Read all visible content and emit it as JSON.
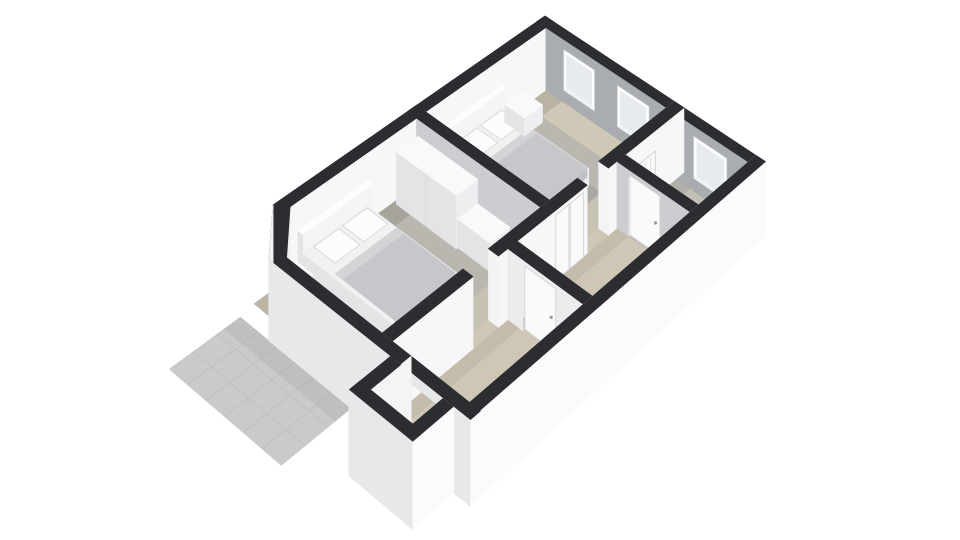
{
  "scene": {
    "title": "3D Floor Plan",
    "type": "3d-floorplan-render",
    "view": "birds-eye dollhouse rendering, no visible text",
    "rooms": [
      {
        "id": "bedroom-1",
        "desc": "large bedroom top-right with double bed, nightstand, two windows"
      },
      {
        "id": "bedroom-2",
        "desc": "bedroom left with double bed, nightstand, wardrobe and dresser"
      },
      {
        "id": "hallway",
        "desc": "central hall with staircase, interior doors and closet"
      },
      {
        "id": "bathroom",
        "desc": "small room at right corner with window and toilet"
      },
      {
        "id": "entry-bay",
        "desc": "projecting bay at lower left with window"
      },
      {
        "id": "patio",
        "desc": "outdoor tiled terrace at lower left"
      }
    ]
  },
  "palette": {
    "bg": "#ffffff",
    "wallTop": "#2b2d30",
    "wallWhite": "#f7f7f8",
    "wallLight": "#ececee",
    "wallMid": "#cbcdd0",
    "wallShade": "#d9dadc",
    "wallGrey": "#a9acb0",
    "extWhite": "#fbfbfc",
    "extLight": "#e7e8ea",
    "extChamfer": "#f0f0f2",
    "doorWhite": "#fafafa",
    "doorStroke": "#d2d2d5",
    "frame": "#ffffff",
    "glass": "#e8ebed",
    "sill": "#f1f2f3",
    "jamb": "#f4f4f5",
    "floorBedroom": "#bab7b0",
    "floorBeigeNE": "#cfc8b7",
    "floorBeigeSE": "#c8c2b3",
    "floorHall": "#cfc7b5",
    "floorBath": "#c2bfb7",
    "patio": "#c9cacc",
    "patioLine": "#bcbdbf",
    "furnWhite": "#f5f5f6",
    "furnSide": "#e4e4e7",
    "furnSide2": "#eeeef0",
    "furnTop": "#f9f9fa",
    "duvet": "#c6c7ca",
    "duvetDrape": "#bfc0c3",
    "duvetFold": "#d3d4d6",
    "mattress": "#f1f1f2",
    "pillow": "#fcfcfd",
    "pillowStroke": "#dadadd",
    "headboardTop": "#fdfdfe",
    "stairTread": "#d5cdbb",
    "stairRiser": "#f1f1f2",
    "handle": "#97979c",
    "radiatorFill": "#f9f9fa",
    "radiatorLine": "#dcdcdf",
    "wardrobeSeam": "#d8d8db",
    "shadow": "rgba(70,72,78,0.14)",
    "aoSoft": "rgba(0,0,0,0.08)",
    "aoLight": "rgba(0,0,0,0.05)",
    "aoDark": "rgba(0,0,0,0.10)",
    "beigeGlow": "rgba(235,225,200,0.45)"
  },
  "projection": {
    "corners": {
      "w": [
        234,
        232
      ],
      "n": [
        545,
        16
      ],
      "e": [
        766,
        162
      ],
      "s": [
        470,
        420
      ]
    },
    "planSize": [
      10,
      7
    ],
    "floorDepth": 72,
    "groundDepth": 80
  },
  "structure": {
    "chamfer": {
      "outerA": [
        1.1,
        0
      ],
      "outerB": [
        0,
        1.1
      ],
      "innerA": [
        1.32,
        0.3
      ],
      "innerB": [
        0.3,
        1.32
      ]
    },
    "nw": {
      "face": {
        "v": 0.3,
        "u": [
          1.32,
          9.7
        ]
      },
      "top": [
        [
          1.1,
          0
        ],
        [
          10,
          0
        ],
        [
          10,
          0.3
        ],
        [
          1.32,
          0.3
        ]
      ]
    },
    "ne": {
      "face": {
        "u": 9.7,
        "v": [
          0.3,
          6.7
        ]
      },
      "top": [
        9.7,
        0,
        10,
        7
      ]
    },
    "pa": {
      "u": [
        5.2,
        5.5
      ],
      "v": [
        0.3,
        4.2
      ],
      "top": [
        5.2,
        0,
        5.5,
        4.5
      ]
    },
    "pb": {
      "v": [
        4.2,
        4.5
      ],
      "segs": [
        [
          5.2,
          6.45
        ],
        [
          7.2,
          10
        ]
      ],
      "jambU": 7.2
    },
    "pc": {
      "u": [
        7.5,
        7.8
      ],
      "vTop": [
        4.5,
        7
      ],
      "faceV": [
        4.5,
        6.7
      ],
      "doorV": [
        4.85,
        5.75
      ]
    },
    "pd": {
      "v": [
        4.2,
        4.5
      ],
      "segs": [
        [
          0.3,
          2.7
        ],
        [
          3.5,
          5.2
        ]
      ],
      "jambU": 3.5
    },
    "pe": {
      "u": [
        3.8,
        4.1
      ],
      "vTop": [
        4.5,
        7
      ],
      "faceV": [
        4.5,
        6.7
      ],
      "doorV": [
        4.95,
        5.85
      ]
    },
    "se": {
      "intV": 6.7,
      "extV": 7,
      "u": [
        0,
        10
      ],
      "top": [
        0,
        6.7,
        10,
        7
      ]
    },
    "sw": {
      "intU": 0.3,
      "extU": 0,
      "intSegs": [
        [
          1.32,
          5.05
        ],
        [
          6.25,
          6.7
        ]
      ],
      "extSegs": [
        [
          1.1,
          5.05
        ],
        [
          6.25,
          7
        ]
      ],
      "bayGapV": [
        5.05,
        6.25
      ],
      "top": [
        [
          0,
          1.1
        ],
        [
          0,
          7
        ],
        [
          0.3,
          7
        ],
        [
          0.3,
          1.32
        ]
      ]
    },
    "bay": {
      "floor": [
        -0.85,
        5.05,
        0.3,
        6.25
      ],
      "intFace": {
        "v": 5.05,
        "u": [
          -0.85,
          0.3
        ]
      },
      "swInt": {
        "u": -0.85,
        "v": [
          5.05,
          6.25
        ]
      },
      "swExt": {
        "u": -1.15,
        "v": [
          4.75,
          6.55
        ]
      },
      "seExt": {
        "v": 6.55,
        "u": [
          -1.15,
          0
        ]
      },
      "nwTop": [
        -1.15,
        4.75,
        0,
        5.05
      ],
      "swTop": [
        -1.15,
        4.75,
        -0.85,
        6.55
      ],
      "seTop": [
        -1.15,
        6.25,
        0,
        6.55
      ]
    }
  },
  "floors": {
    "bedroom1": [
      5.5,
      0.3,
      9.7,
      4.2
    ],
    "bedroom2": [
      0.3,
      0.3,
      5.2,
      4.2
    ],
    "bathroom": [
      7.8,
      4.5,
      9.7,
      6.7
    ],
    "hallway": [
      0.3,
      4.5,
      7.5,
      6.7
    ],
    "patchPB": [
      6.45,
      4.2,
      7.2,
      4.5
    ],
    "patchPD": [
      2.7,
      4.2,
      3.5,
      4.5
    ],
    "patchPC": [
      7.5,
      4.85,
      7.8,
      5.75
    ]
  },
  "windows": [
    {
      "id": "bedroom-1-window-1",
      "wall": "ne",
      "v": [
        0.9,
        1.9
      ]
    },
    {
      "id": "bedroom-1-window-2",
      "wall": "ne",
      "v": [
        2.65,
        3.65
      ]
    },
    {
      "id": "bathroom-window",
      "wall": "ne",
      "v": [
        5.05,
        6.05
      ]
    },
    {
      "id": "bedroom-2-window",
      "wall": "sw",
      "v": [
        1.95,
        3.05
      ]
    },
    {
      "id": "bay-window",
      "wall": "bay",
      "v": [
        5.15,
        6.15
      ]
    }
  ],
  "furniture": {
    "bed1": {
      "u": [
        6.15,
        7.95
      ],
      "v": [
        0.35,
        3.05
      ]
    },
    "nightstand1": {
      "u": [
        8.15,
        8.8
      ],
      "v": [
        0.35,
        1.0
      ],
      "zTop": 52
    },
    "bed2": {
      "u": [
        1.7,
        3.5
      ],
      "v": [
        0.35,
        3.05
      ]
    },
    "nightstand2": {
      "u": [
        0.75,
        1.35
      ],
      "v": [
        0.35,
        1.0
      ],
      "zTop": 52
    },
    "wardrobe": {
      "u": [
        4.45,
        5.15
      ],
      "v": [
        0.4,
        2.3
      ],
      "zTop": 16
    },
    "dresser": {
      "u": [
        4.5,
        5.15
      ],
      "v": [
        2.3,
        3.3
      ],
      "zTop": 42
    },
    "toilet": {
      "tank": [
        8.1,
        4.62,
        8.62,
        4.88
      ],
      "bowl": [
        8.18,
        4.88,
        8.54,
        5.3
      ]
    },
    "radiator": {
      "u": [
        8.0,
        8.9
      ],
      "z": [
        22,
        52
      ],
      "v": 4.51
    },
    "closetDoors": {
      "panels": [
        [
          5.35,
          5.8
        ],
        [
          5.84,
          6.3
        ]
      ],
      "z": [
        4,
        72
      ],
      "v": 4.52
    },
    "staircase": {
      "u": [
        4.55,
        6.45
      ],
      "v": [
        5.95,
        6.68
      ],
      "steps": 5,
      "drop": 5
    },
    "bathroomDoor": {
      "u": 7.56,
      "v": [
        4.85,
        5.75
      ],
      "handle": [
        5.62,
        40
      ]
    },
    "hallDoor": {
      "u": 3.86,
      "v": [
        4.95,
        5.85
      ],
      "handle": [
        5.72,
        40
      ]
    }
  },
  "patio": {
    "u": [
      -1.9,
      0
    ],
    "v": [
      0.2,
      3.6
    ],
    "cols": 6,
    "rows": 3
  }
}
